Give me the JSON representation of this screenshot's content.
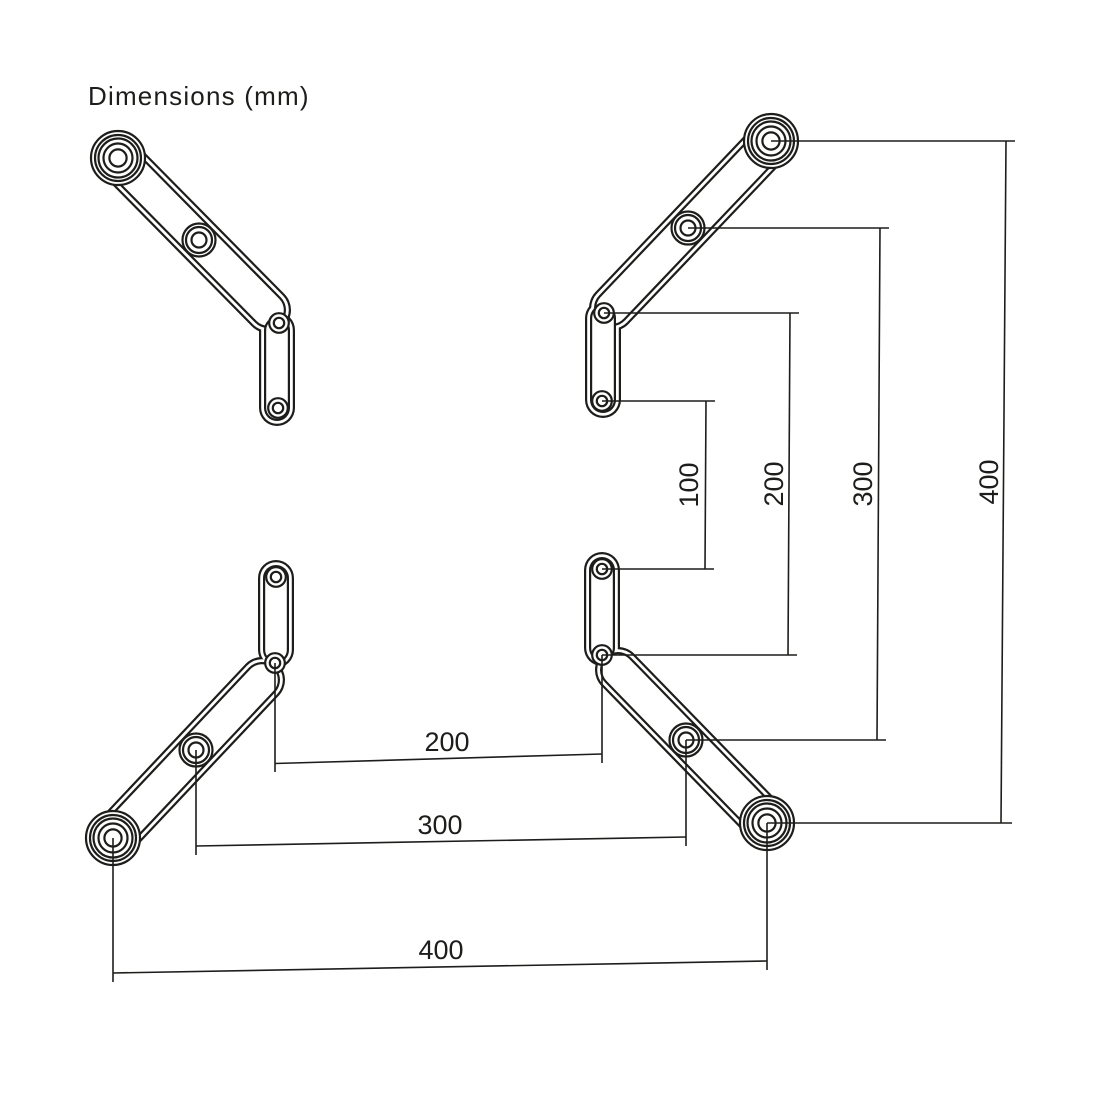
{
  "title": "Dimensions (mm)",
  "unit": "mm",
  "colors": {
    "background": "#ffffff",
    "line": "#1d1d1b"
  },
  "dimensions": {
    "vertical": [
      {
        "label": "100"
      },
      {
        "label": "200"
      },
      {
        "label": "300"
      },
      {
        "label": "400"
      }
    ],
    "horizontal": [
      {
        "label": "200"
      },
      {
        "label": "300"
      },
      {
        "label": "400"
      }
    ]
  }
}
